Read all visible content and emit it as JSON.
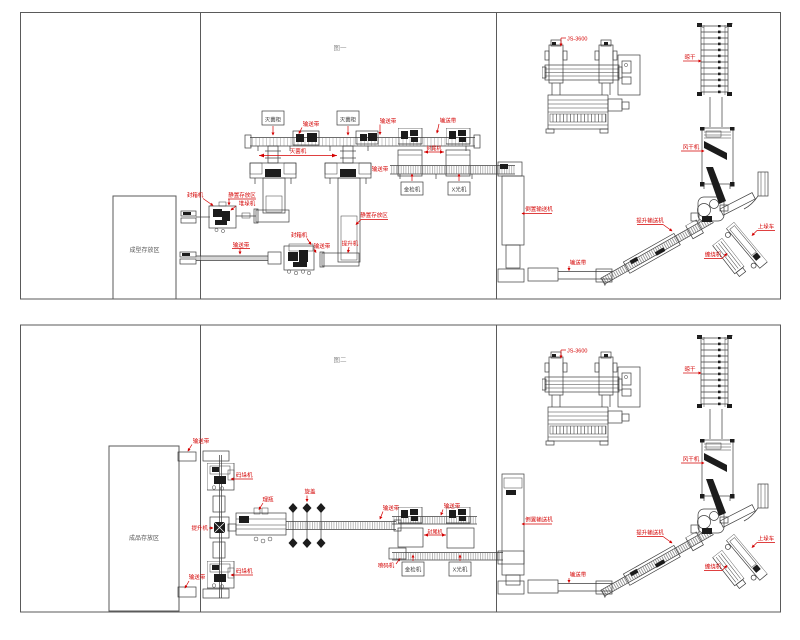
{
  "colors": {
    "line": "#3c3c3c",
    "label_red": "#d40000",
    "caption_gray": "#8f8f8f"
  },
  "fig1": {
    "caption": "图一",
    "labels": {
      "storage_area": "成型存放区",
      "tower_box_1": "灭菌柜",
      "tower_box_2": "灭菌柜",
      "belt_top": "输送带",
      "dim_towers": "灭菌机",
      "belt_r1": "输送带",
      "belt_r2": "输送带",
      "dim_pair": "封尾机",
      "belt_lower_left": "输送带",
      "det_box_1": "金检机",
      "det_box_2": "X光机",
      "sealer_a": "封箱机",
      "staging_a": "静置存放区",
      "palletizer_a": "堆垛机",
      "belt_b1": "输送带",
      "sealer_b": "封箱机",
      "belt_b2": "输送带",
      "lift_b": "提升机",
      "staging_tower": "静置存放区",
      "inverter": "倒置输送机",
      "exit_belt": "输送带",
      "incline": "提升输送机",
      "dry_tower": "晾干",
      "dryer": "风干机",
      "wrapper": "缠绕机",
      "truck": "上垛车",
      "js3600": "JS-3600"
    }
  },
  "fig2": {
    "caption": "图二",
    "labels": {
      "storage_area": "成品存放区",
      "infeed_belt": "输送带",
      "palletizer_1": "码垛机",
      "lift": "提升机",
      "palletizer_2": "码垛机",
      "outfeed_belt": "输送带",
      "unscrambler": "理瓶",
      "capper": "旋盖",
      "belt_mid": "输送带",
      "coder": "喷码机",
      "belt_r": "输送带",
      "dim_pair": "封尾机",
      "det_box_1": "金检机",
      "det_box_2": "X光机",
      "inverter": "倒置输送机",
      "exit_belt": "输送带",
      "incline": "提升输送机",
      "dry_tower": "晾干",
      "dryer": "风干机",
      "wrapper": "缠绕机",
      "truck": "上垛车",
      "js3600": "JS-3600"
    }
  }
}
